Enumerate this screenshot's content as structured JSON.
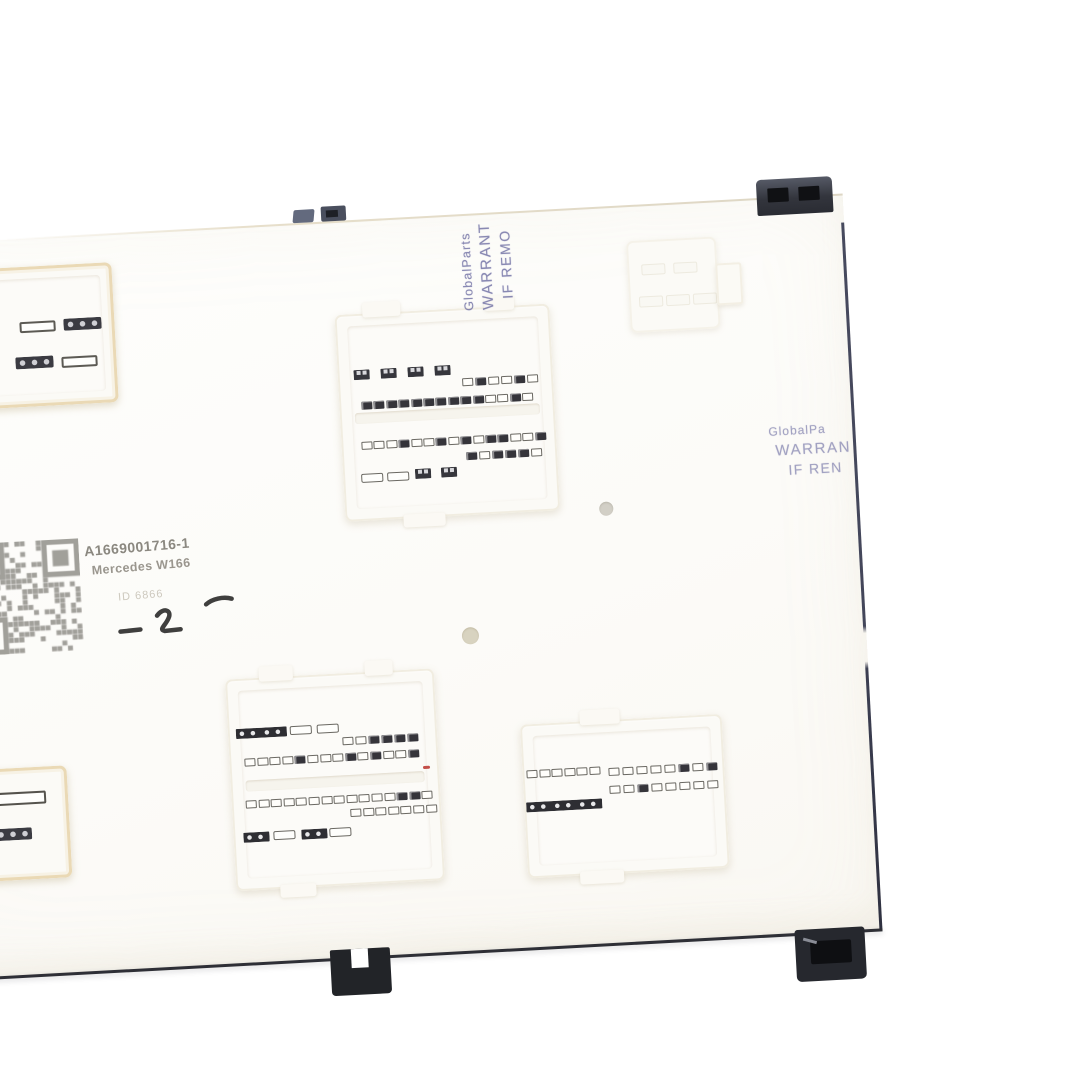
{
  "scene": {
    "type": "product-photo",
    "subject": "Mercedes-Benz W166 SAM control module (fuse box unit), connector side",
    "background_color": "#ffffff"
  },
  "label": {
    "part_number": "A1669001716-1",
    "model": "Mercedes W166",
    "stamp": "ID 6866",
    "handwritten_mark": "-2-"
  },
  "stickers": {
    "top": {
      "lines": [
        "GlobalParts",
        "WARRANT",
        "IF REMO"
      ]
    },
    "right": {
      "lines": [
        "GlobalPa",
        "WARRAN",
        "IF REN"
      ]
    }
  },
  "colors": {
    "sticker_text": "#6f6fa3",
    "label_text": "#8b8880",
    "module_edge_right": "#43465a",
    "module_edge_bottom": "#2e2f36",
    "clip_black": "#26282e",
    "clip_slate": "#5c6172",
    "connector_warm_rim": "#ead9b5",
    "qr_gray": "#918f8a",
    "red_dot": "#c4504a"
  }
}
